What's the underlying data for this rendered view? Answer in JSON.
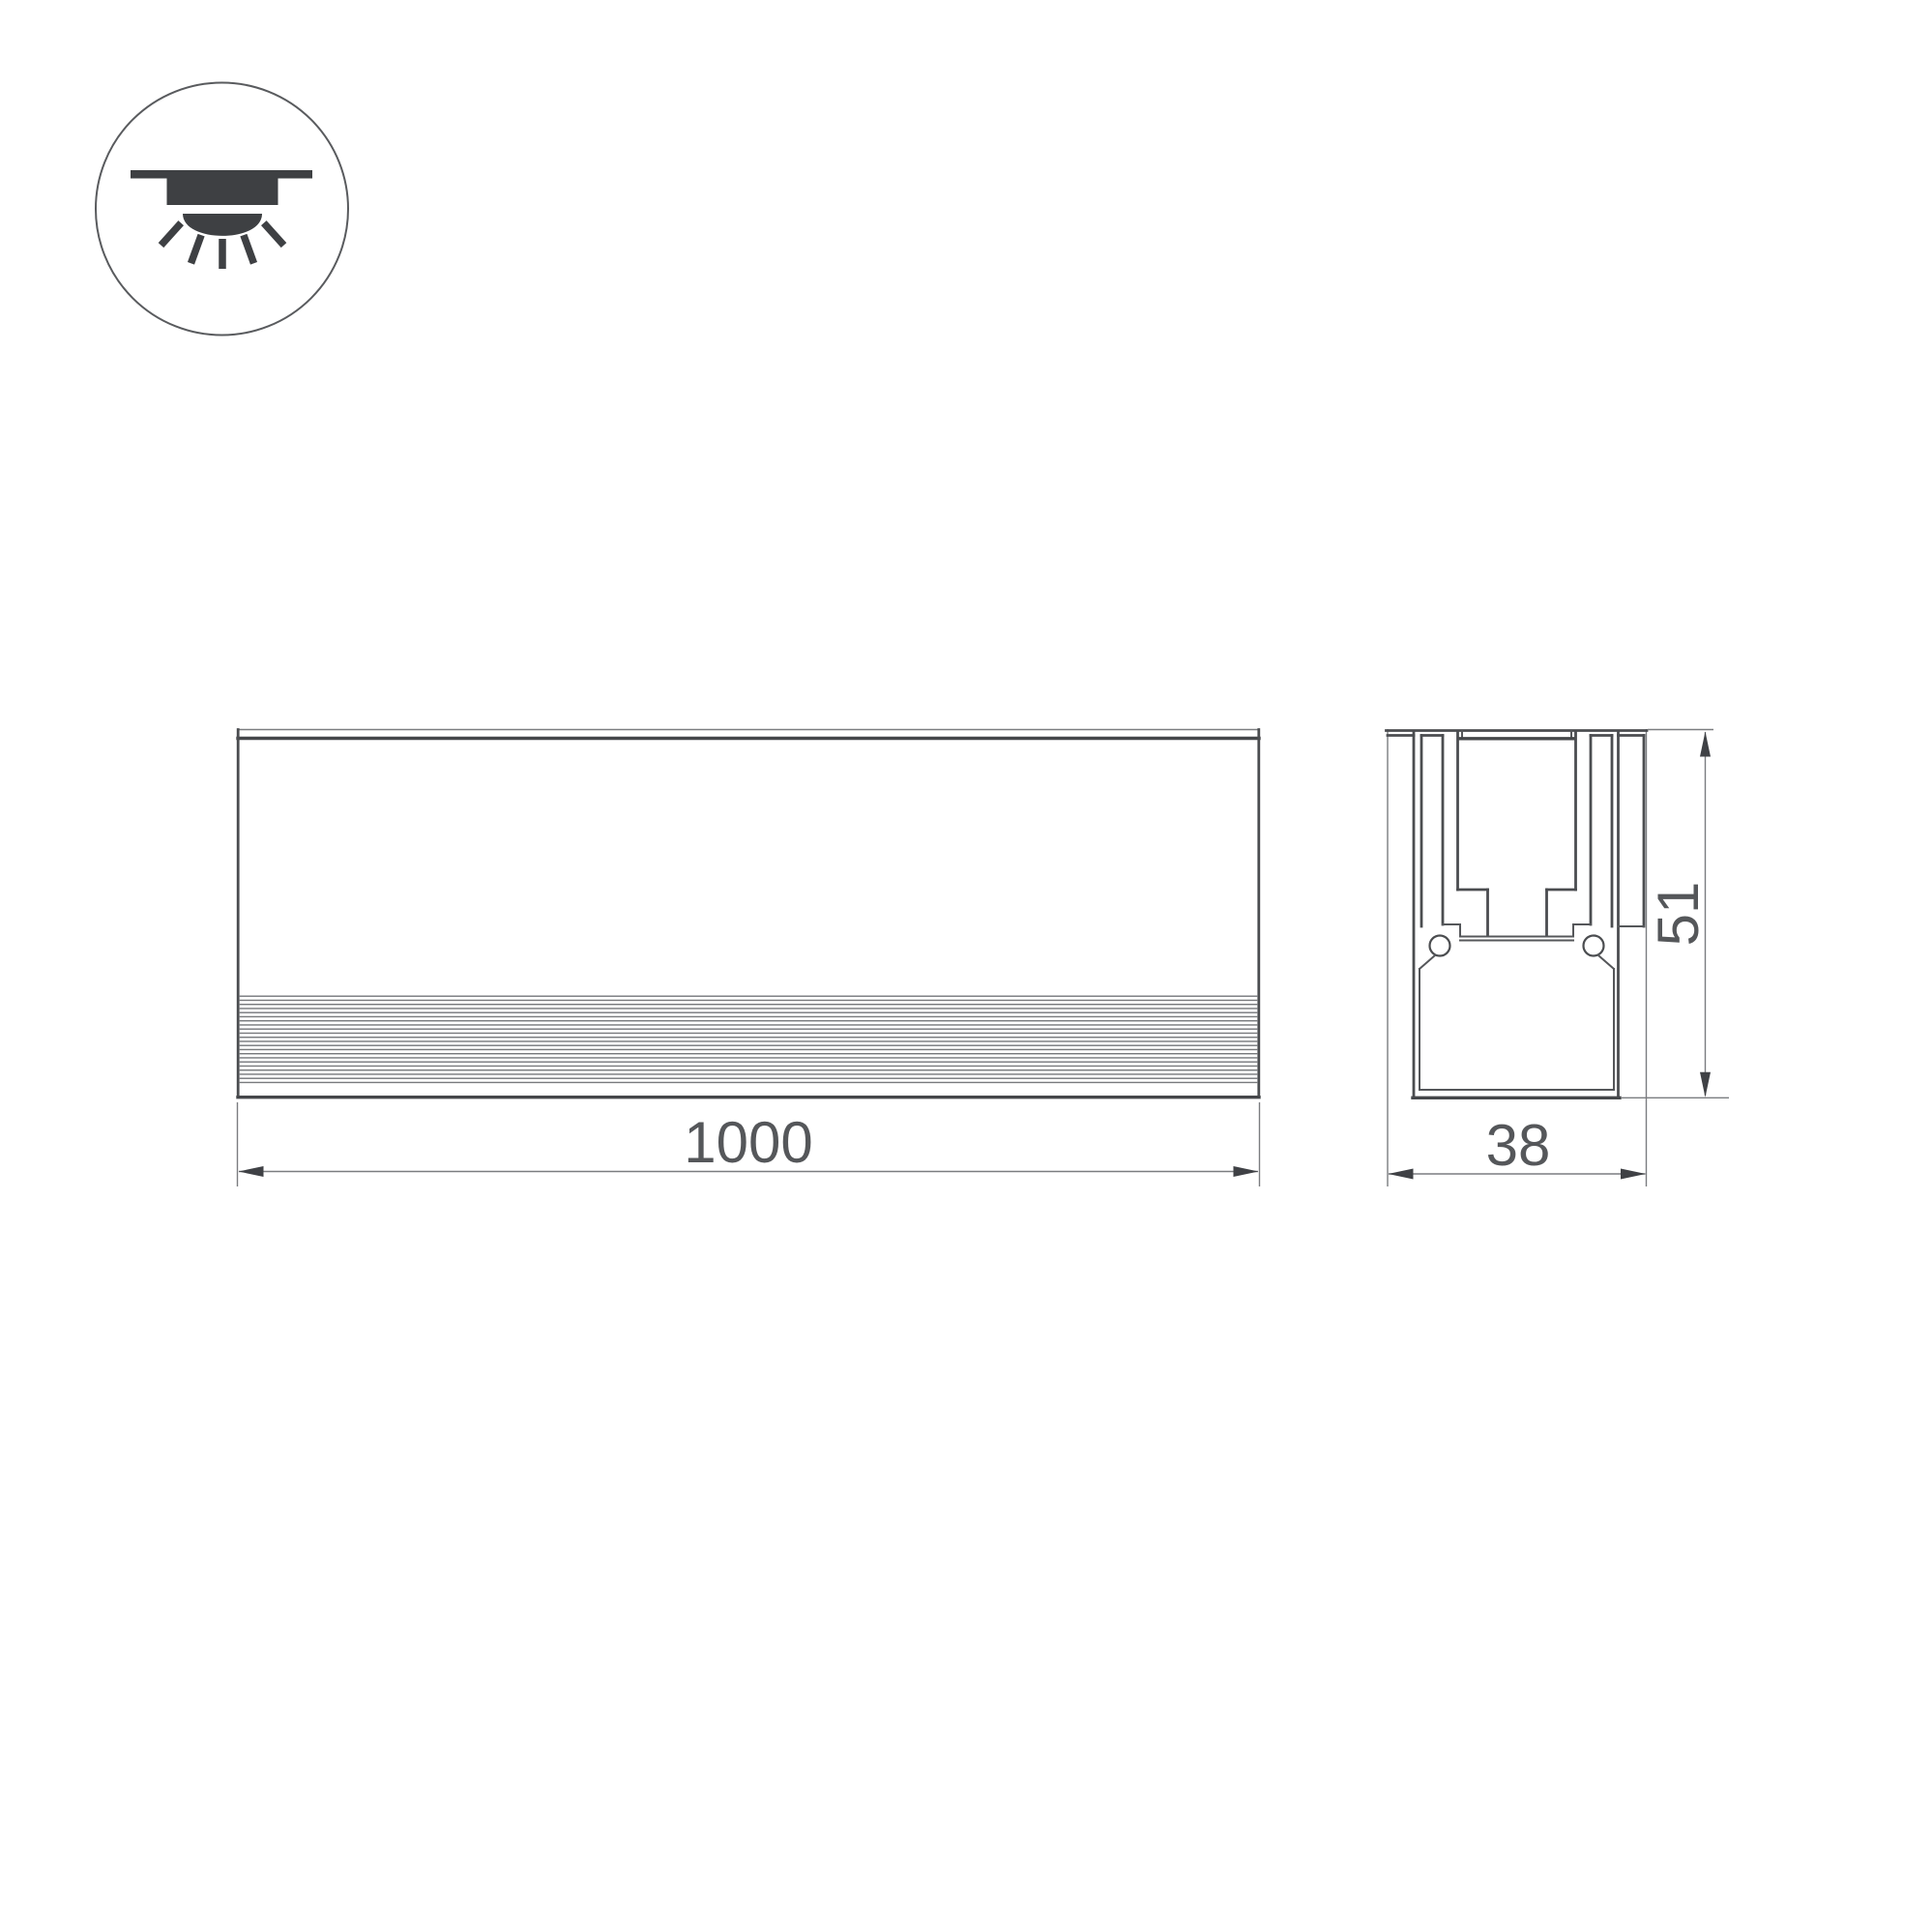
{
  "icon": {
    "name": "recessed-downlight-icon"
  },
  "views": {
    "front": {
      "length_label": "1000"
    },
    "section": {
      "width_label": "38",
      "height_label": "51"
    }
  },
  "colors": {
    "background": "#ffffff",
    "line_dark": "#4b4d50",
    "line_thin": "#7b7d80",
    "dimension_text": "#55575a",
    "icon_fill": "#3e4043"
  }
}
